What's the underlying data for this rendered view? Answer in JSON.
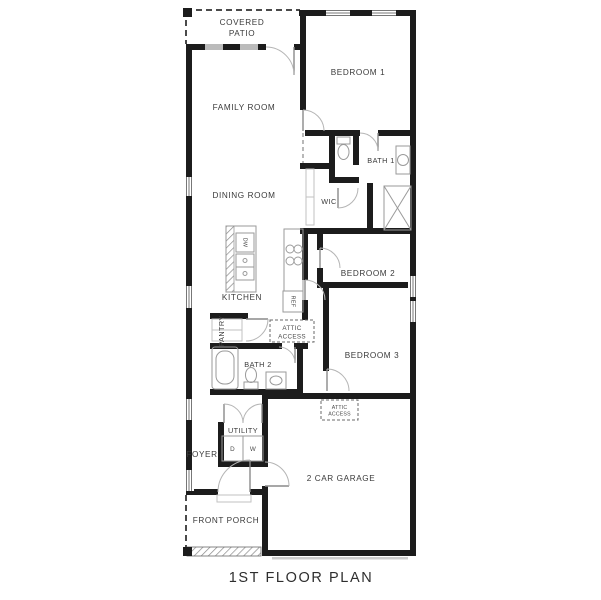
{
  "title": "1ST FLOOR PLAN",
  "colors": {
    "wall": "#1c1c1c",
    "thin_line": "#9a9a9a",
    "text": "#3a3a3a",
    "background": "#ffffff"
  },
  "rooms": {
    "covered_patio": {
      "line1": "COVERED",
      "line2": "PATIO"
    },
    "family_room": {
      "label": "FAMILY ROOM"
    },
    "bedroom1": {
      "label": "BEDROOM 1"
    },
    "bath1": {
      "label": "BATH 1"
    },
    "dining_room": {
      "label": "DINING ROOM"
    },
    "wic": {
      "label": "WIC"
    },
    "bedroom2": {
      "label": "BEDROOM 2"
    },
    "kitchen": {
      "label": "KITCHEN"
    },
    "pantry": {
      "label": "PANTRY"
    },
    "attic_access_hall": {
      "line1": "ATTIC",
      "line2": "ACCESS"
    },
    "bath2": {
      "label": "BATH 2"
    },
    "bedroom3": {
      "label": "BEDROOM 3"
    },
    "attic_access_garage": {
      "line1": "ATTIC",
      "line2": "ACCESS"
    },
    "utility": {
      "label": "UTILITY"
    },
    "foyer": {
      "label": "FOYER"
    },
    "garage": {
      "label": "2 CAR GARAGE"
    },
    "front_porch": {
      "label": "FRONT PORCH"
    }
  },
  "appliances": {
    "dishwasher": "DW",
    "refrigerator": "REF",
    "dryer": "D",
    "washer": "W"
  }
}
